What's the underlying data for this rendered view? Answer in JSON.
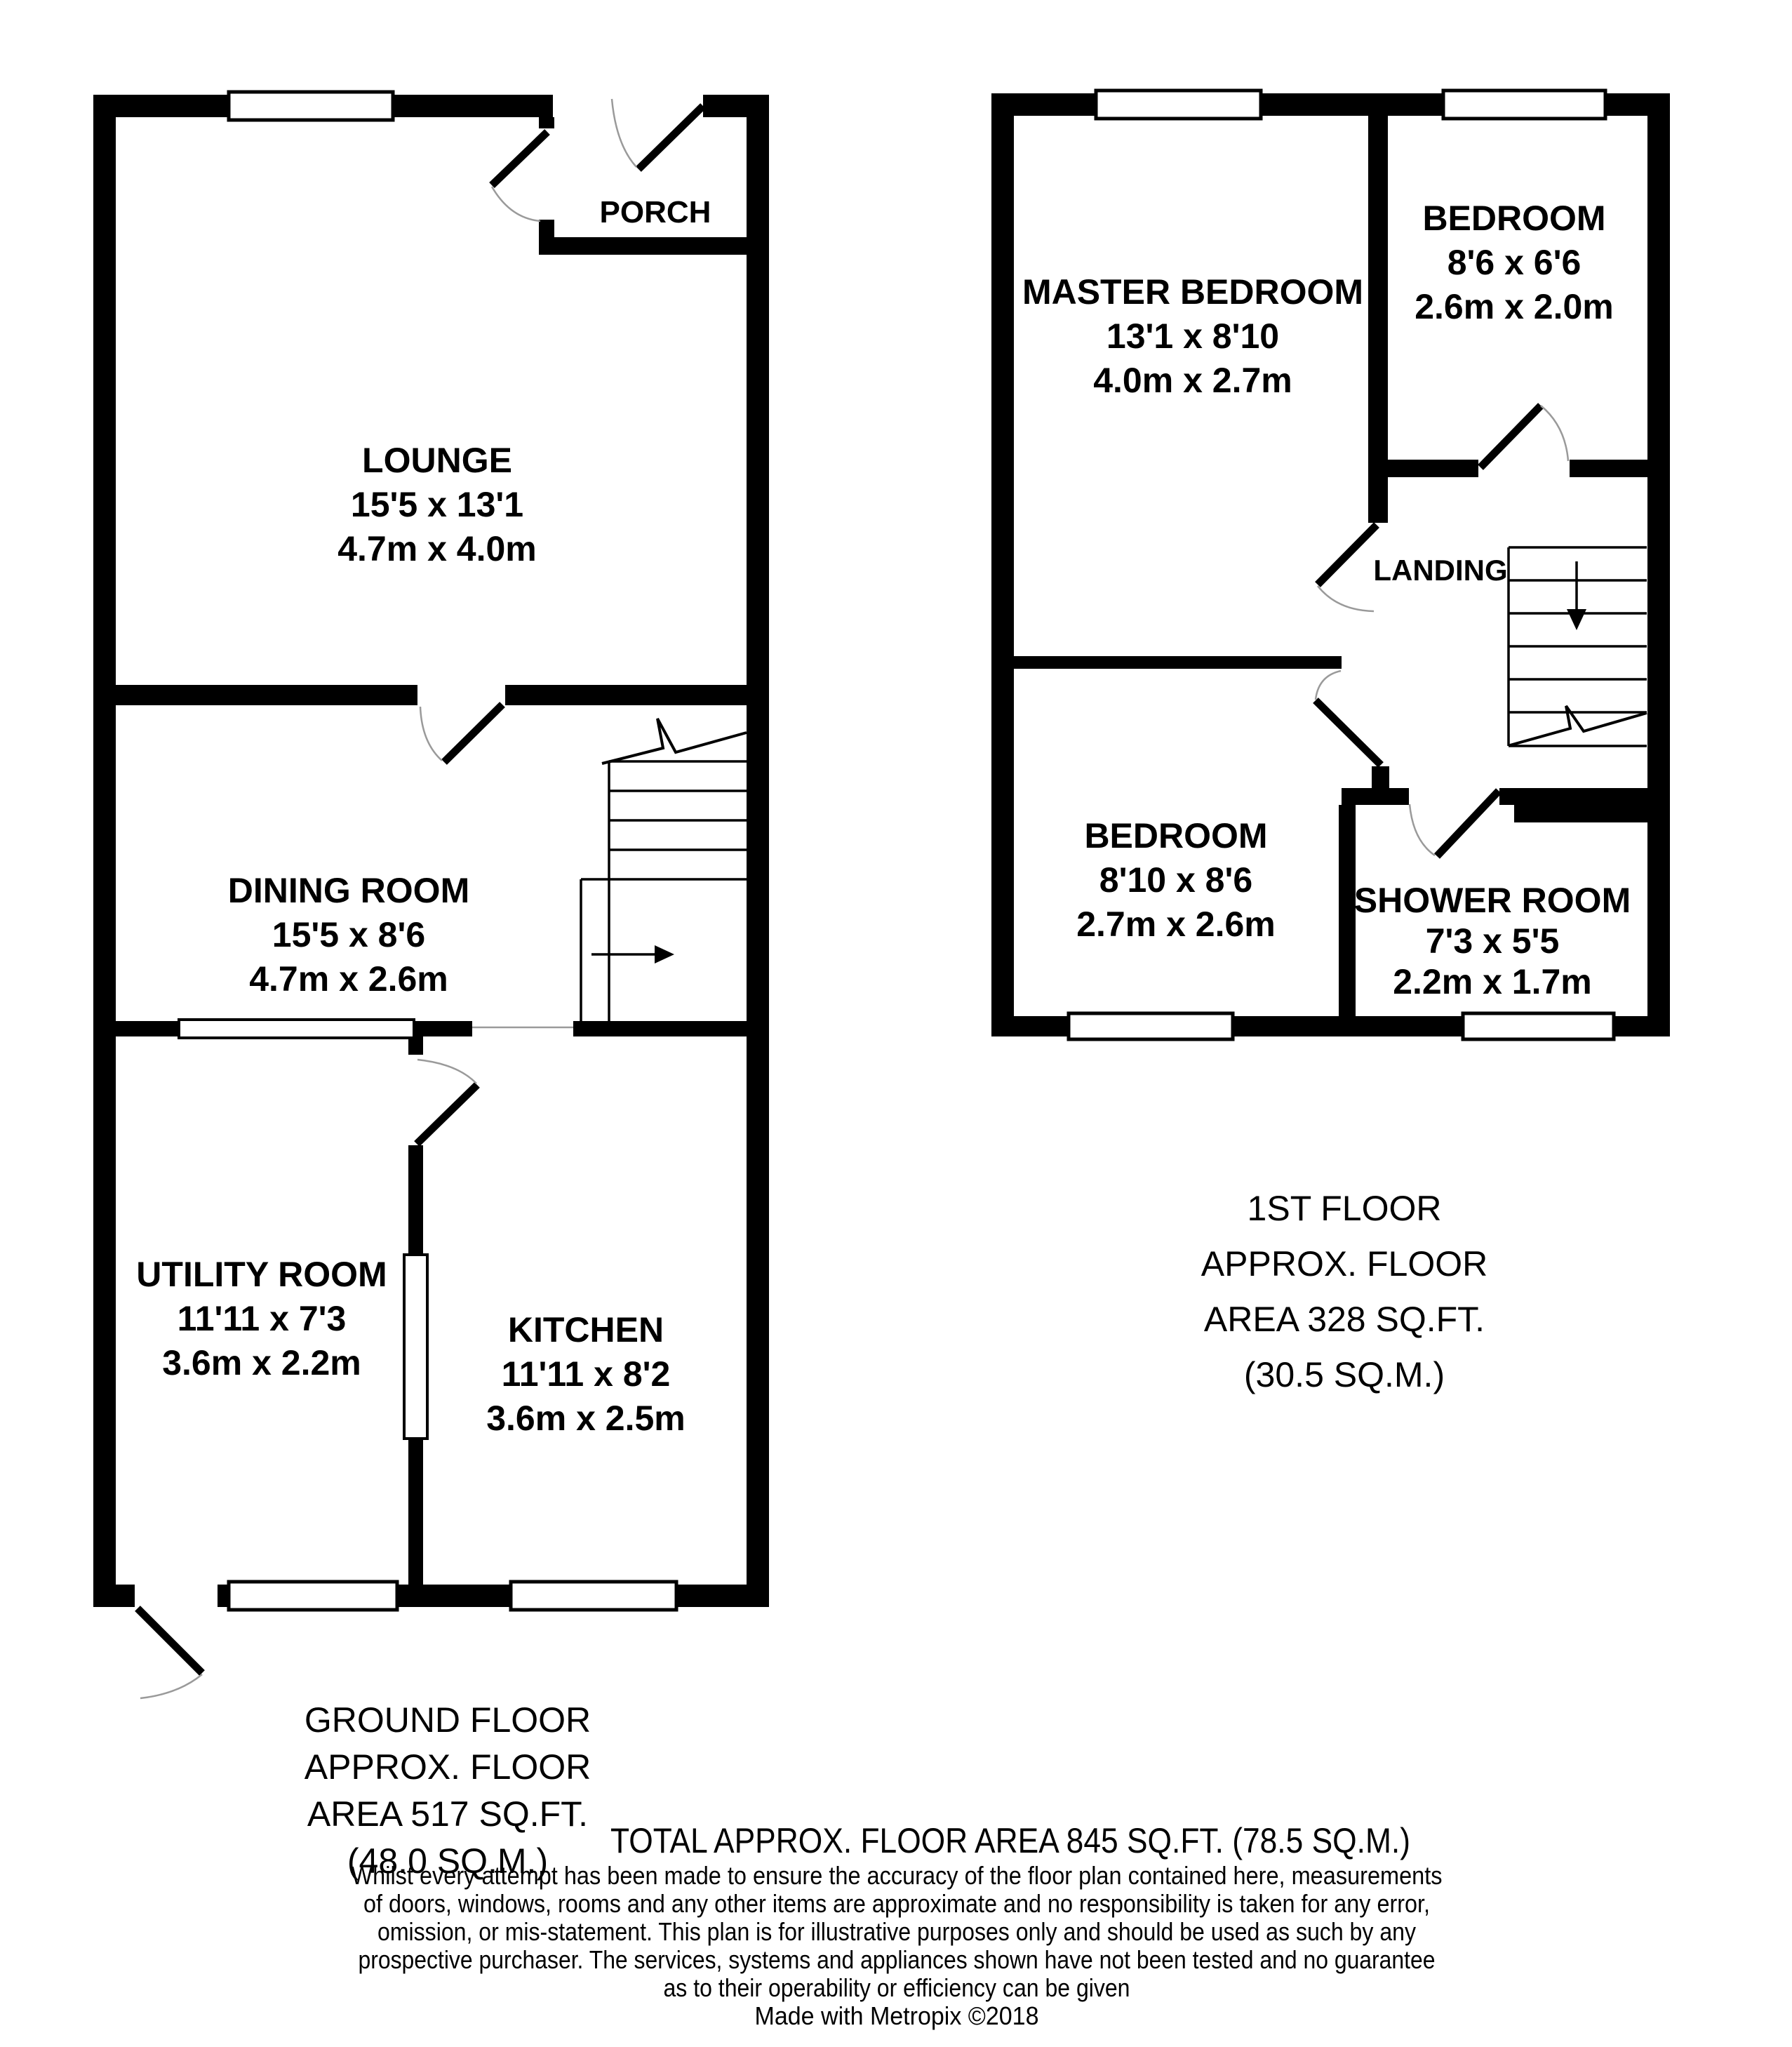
{
  "ground_floor": {
    "rooms": {
      "lounge": {
        "name": "LOUNGE",
        "dims_ft": "15'5 x 13'1",
        "dims_m": "4.7m x 4.0m"
      },
      "porch": {
        "name": "PORCH"
      },
      "dining": {
        "name": "DINING ROOM",
        "dims_ft": "15'5 x 8'6",
        "dims_m": "4.7m x 2.6m"
      },
      "utility": {
        "name": "UTILITY ROOM",
        "dims_ft": "11'11 x 7'3",
        "dims_m": "3.6m x 2.2m"
      },
      "kitchen": {
        "name": "KITCHEN",
        "dims_ft": "11'11 x 8'2",
        "dims_m": "3.6m x 2.5m"
      }
    },
    "area_label": {
      "line1": "GROUND FLOOR",
      "line2": "APPROX. FLOOR",
      "line3": "AREA 517 SQ.FT.",
      "line4": "(48.0 SQ.M.)"
    }
  },
  "first_floor": {
    "rooms": {
      "master": {
        "name": "MASTER BEDROOM",
        "dims_ft": "13'1 x 8'10",
        "dims_m": "4.0m x 2.7m"
      },
      "bedroom2": {
        "name": "BEDROOM",
        "dims_ft": "8'6 x 6'6",
        "dims_m": "2.6m x 2.0m"
      },
      "landing": {
        "name": "LANDING"
      },
      "bedroom3": {
        "name": "BEDROOM",
        "dims_ft": "8'10 x 8'6",
        "dims_m": "2.7m x 2.6m"
      },
      "shower": {
        "name": "SHOWER ROOM",
        "dims_ft": "7'3 x 5'5",
        "dims_m": "2.2m x 1.7m"
      }
    },
    "area_label": {
      "line1": "1ST FLOOR",
      "line2": "APPROX. FLOOR",
      "line3": "AREA 328 SQ.FT.",
      "line4": "(30.5 SQ.M.)"
    }
  },
  "footer": {
    "total": "TOTAL APPROX. FLOOR AREA 845 SQ.FT. (78.5 SQ.M.)",
    "disclaimer": {
      "line1": "Whilst every attempt has been made to ensure the accuracy of the floor plan contained here, measurements",
      "line2": "of doors, windows, rooms and any other items are approximate and no responsibility is taken for any error,",
      "line3": "omission, or mis-statement. This plan is for illustrative purposes only and should be used as such by any",
      "line4": "prospective purchaser. The services, systems and appliances shown have not been tested and no guarantee",
      "line5": "as to their operability or efficiency can be given"
    },
    "credit": "Made with Metropix ©2018"
  },
  "colors": {
    "wall": "#000000",
    "background": "#ffffff",
    "door_arc": "#9a9a9a"
  }
}
